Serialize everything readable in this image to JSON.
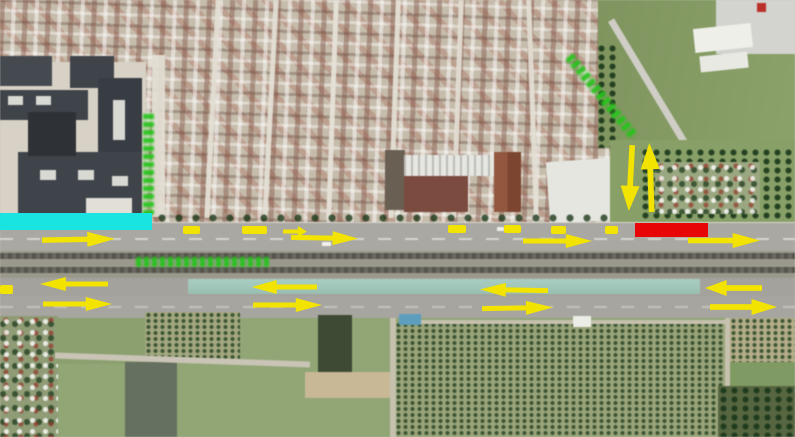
{
  "map": {
    "description": "Aerial satellite photograph of an urban corridor with a highway, railway line and agricultural fields, annotated with traffic-flow arrows and colored road-segment bars",
    "colors": {
      "arrow_yellow": "#f2e300",
      "bar_cyan": "#1ae4e2",
      "bar_red": "#e80505",
      "label_green": "#27c31c"
    },
    "bars": [
      {
        "name": "cyan-segment-bar",
        "x": 0,
        "y": 213,
        "w": 152,
        "h": 17,
        "color": "#1ae4e2"
      },
      {
        "name": "red-segment-bar",
        "x": 635,
        "y": 223,
        "w": 73,
        "h": 14,
        "color": "#e80505"
      }
    ],
    "arrows": [
      {
        "dir": "right",
        "x": 42,
        "y": 232,
        "w": 73,
        "h": 15,
        "r": -1
      },
      {
        "dir": "right",
        "x": 283,
        "y": 226,
        "w": 24,
        "h": 11,
        "r": 0
      },
      {
        "dir": "right",
        "x": 291,
        "y": 231,
        "w": 67,
        "h": 14,
        "r": 1
      },
      {
        "dir": "right",
        "x": 523,
        "y": 234,
        "w": 69,
        "h": 14,
        "r": 0
      },
      {
        "dir": "right",
        "x": 688,
        "y": 233,
        "w": 72,
        "h": 15,
        "r": 0
      },
      {
        "dir": "down",
        "x": 621,
        "y": 145,
        "w": 19,
        "h": 66,
        "r": 3
      },
      {
        "dir": "up",
        "x": 641,
        "y": 143,
        "w": 19,
        "h": 69,
        "r": -2
      },
      {
        "dir": "left",
        "x": 40,
        "y": 277,
        "w": 68,
        "h": 14,
        "r": 0
      },
      {
        "dir": "left",
        "x": 252,
        "y": 280,
        "w": 65,
        "h": 14,
        "r": 0
      },
      {
        "dir": "left",
        "x": 480,
        "y": 283,
        "w": 68,
        "h": 14,
        "r": 1
      },
      {
        "dir": "left",
        "x": 705,
        "y": 280,
        "w": 57,
        "h": 16,
        "r": 0
      },
      {
        "dir": "right",
        "x": 43,
        "y": 297,
        "w": 69,
        "h": 14,
        "r": 0
      },
      {
        "dir": "right",
        "x": 253,
        "y": 298,
        "w": 69,
        "h": 14,
        "r": 0
      },
      {
        "dir": "right",
        "x": 482,
        "y": 301,
        "w": 71,
        "h": 14,
        "r": -1
      },
      {
        "dir": "right",
        "x": 710,
        "y": 299,
        "w": 67,
        "h": 16,
        "r": 0
      }
    ],
    "dashes": [
      {
        "x": 183,
        "y": 226,
        "w": 17,
        "h": 8
      },
      {
        "x": 242,
        "y": 226,
        "w": 25,
        "h": 8
      },
      {
        "x": 448,
        "y": 225,
        "w": 18,
        "h": 8
      },
      {
        "x": 504,
        "y": 225,
        "w": 17,
        "h": 8
      },
      {
        "x": 551,
        "y": 226,
        "w": 15,
        "h": 8
      },
      {
        "x": 605,
        "y": 226,
        "w": 13,
        "h": 8
      },
      {
        "x": 0,
        "y": 285,
        "w": 13,
        "h": 9
      }
    ],
    "green_labels": [
      {
        "name": "street-label-vertical",
        "orientation": "vertical",
        "text": "(illegible green annotation)"
      },
      {
        "name": "railway-label-horizontal",
        "orientation": "horizontal",
        "text": "(illegible green annotation)"
      },
      {
        "name": "street-label-diagonal",
        "orientation": "diagonal",
        "text": "(illegible green annotation)"
      }
    ]
  }
}
